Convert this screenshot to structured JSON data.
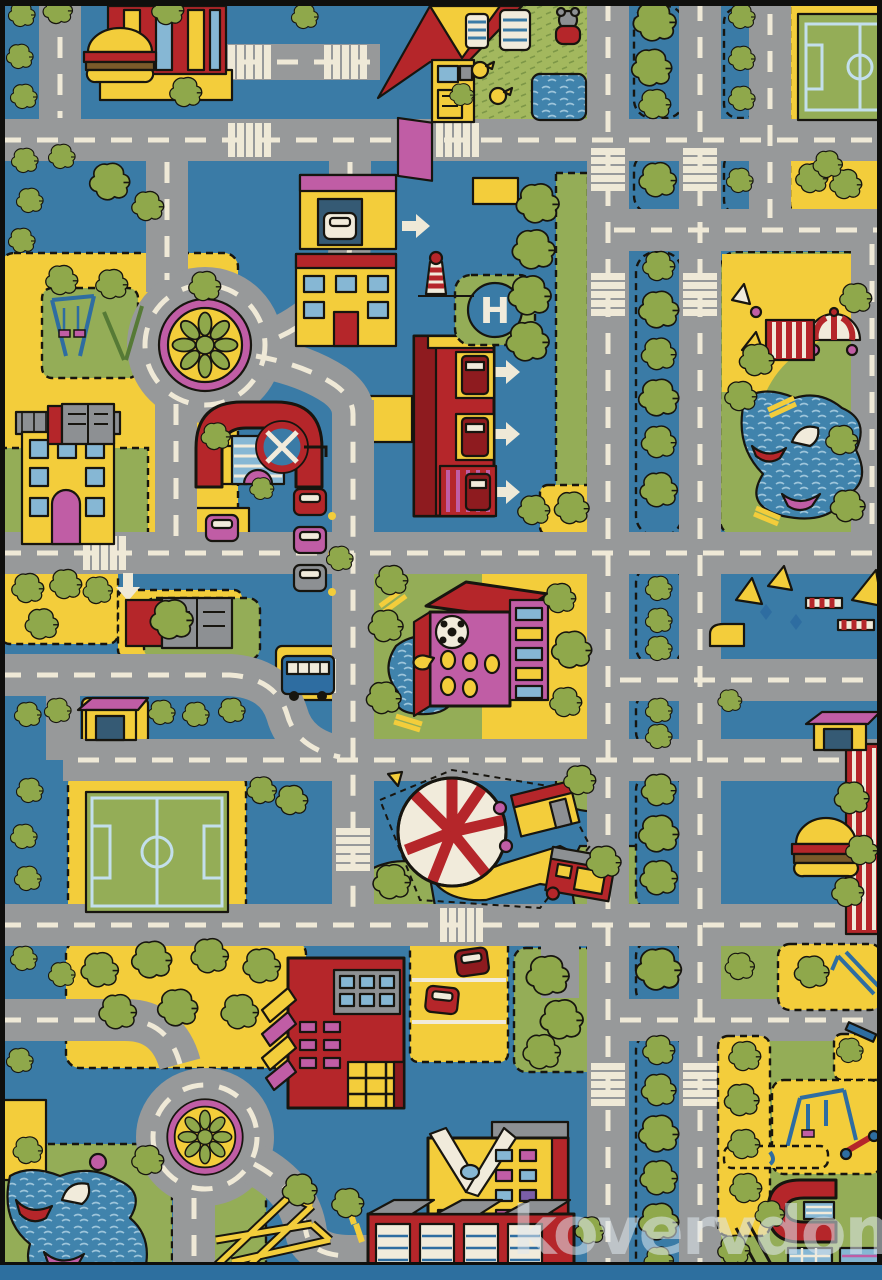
{
  "photo": {
    "subject": "children city roads play rug",
    "watermark_main": "kovervdom",
    "watermark_suffix": ".ru",
    "helipad_letter": "H"
  },
  "palette": {
    "blue": "#3a7ba6",
    "road": "#97999a",
    "dash": "#efe9d7",
    "yellow": "#f3cd3b",
    "grass": "#94ad57",
    "lawn": "#a3b85e",
    "tree": "#8fa84b",
    "red": "#b5262a",
    "dred": "#8e1b1f",
    "pink": "#c05da5",
    "white": "#f1ebdb",
    "ink": "#17150f",
    "glass": "#86b7d4",
    "winblue": "#2e6da1",
    "gray": "#8d9093",
    "lake": "#4083ac",
    "pitchline": "#c3dfec",
    "binding": "#2d6f9f",
    "wm": "#dfe8ef",
    "wmsuffix": "#a3c6e4"
  }
}
